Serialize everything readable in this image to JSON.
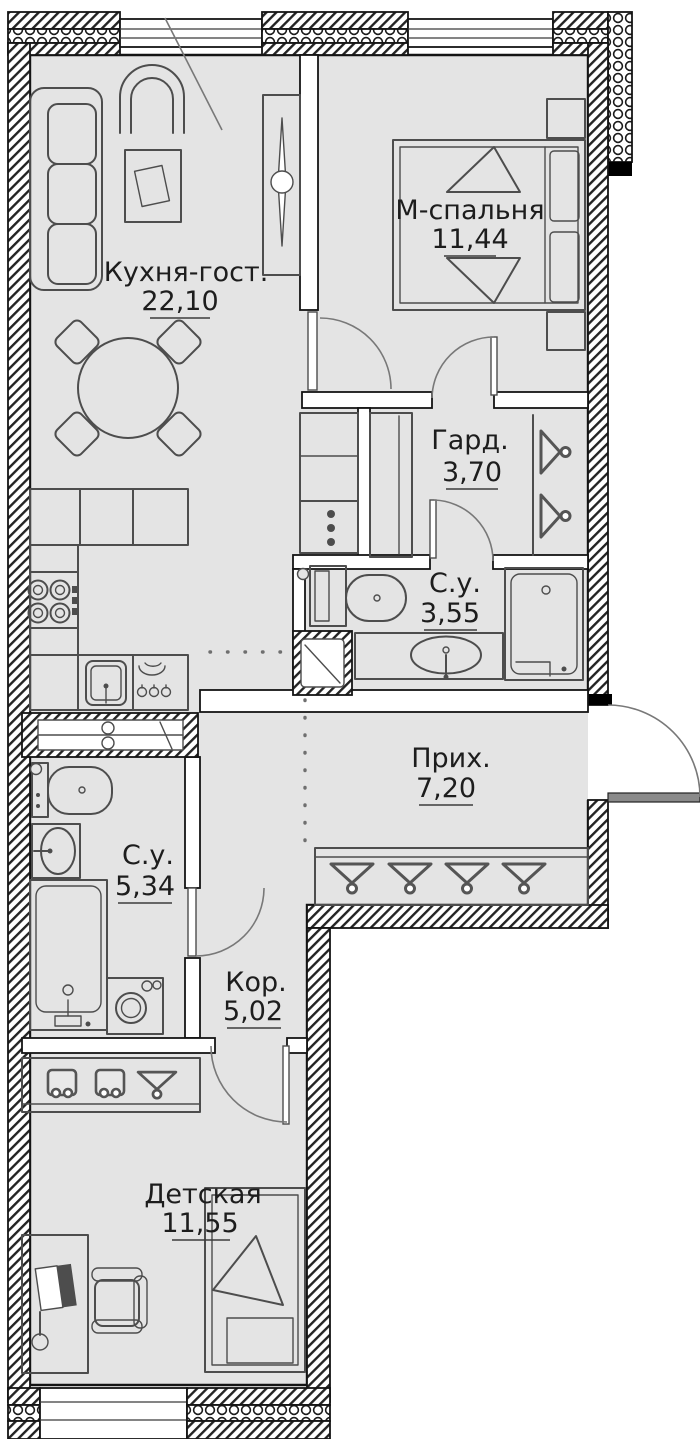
{
  "plan": {
    "rooms": [
      {
        "name": "Кухня-гост.",
        "area": "22,10"
      },
      {
        "name": "М-спальня",
        "area": "11,44"
      },
      {
        "name": "Гард.",
        "area": "3,70"
      },
      {
        "name": "С.у.",
        "area": "3,55"
      },
      {
        "name": "Прих.",
        "area": "7,20"
      },
      {
        "name": "С.у.",
        "area": "5,34"
      },
      {
        "name": "Кор.",
        "area": "5,02"
      },
      {
        "name": "Детская",
        "area": "11,55"
      }
    ],
    "colors": {
      "floor": "#e4e4e4",
      "wall": "#141414",
      "furniture": "#4d4d4d",
      "door_arc": "#787878"
    }
  }
}
